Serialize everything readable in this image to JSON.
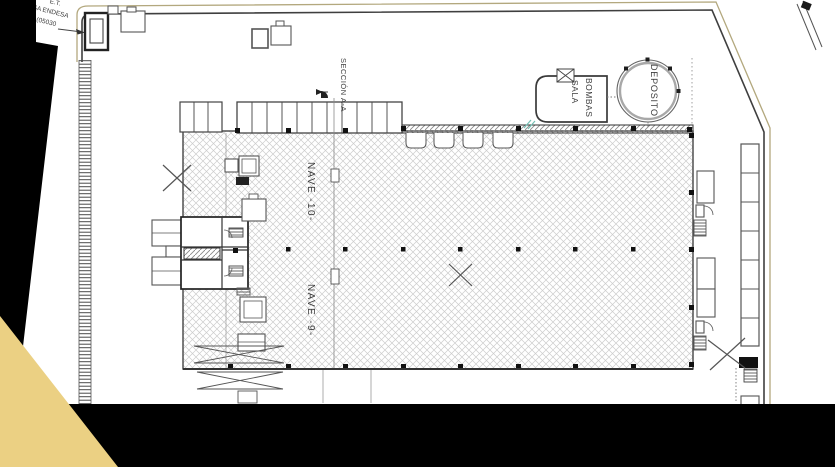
{
  "page": {
    "kind": "architectural-site-plan-scan",
    "width": 835,
    "height": 467
  },
  "plan": {
    "labels": {
      "transformer_line1": "E.T.",
      "transformer_line2": "FECSA ENDESA",
      "transformer_line3": "Núm (05030",
      "section": "SECCIÓN A-A",
      "pump_room_line1": "SALA",
      "pump_room_line2": "BOMBAS",
      "tank": "DEPOSITO",
      "hall_10": "NAVE -10-",
      "hall_9": "NAVE -9-"
    },
    "colors": {
      "line": "#4a4a4a",
      "dark_line": "#222222",
      "hatch": "#cccccc",
      "boundary_outer": "#b3a87e",
      "teal_mark": "#74c0b4",
      "paper": "#ffffff"
    }
  },
  "overlay": {
    "corner_black": "#000000",
    "triangle_yellow": "#ebd083"
  }
}
